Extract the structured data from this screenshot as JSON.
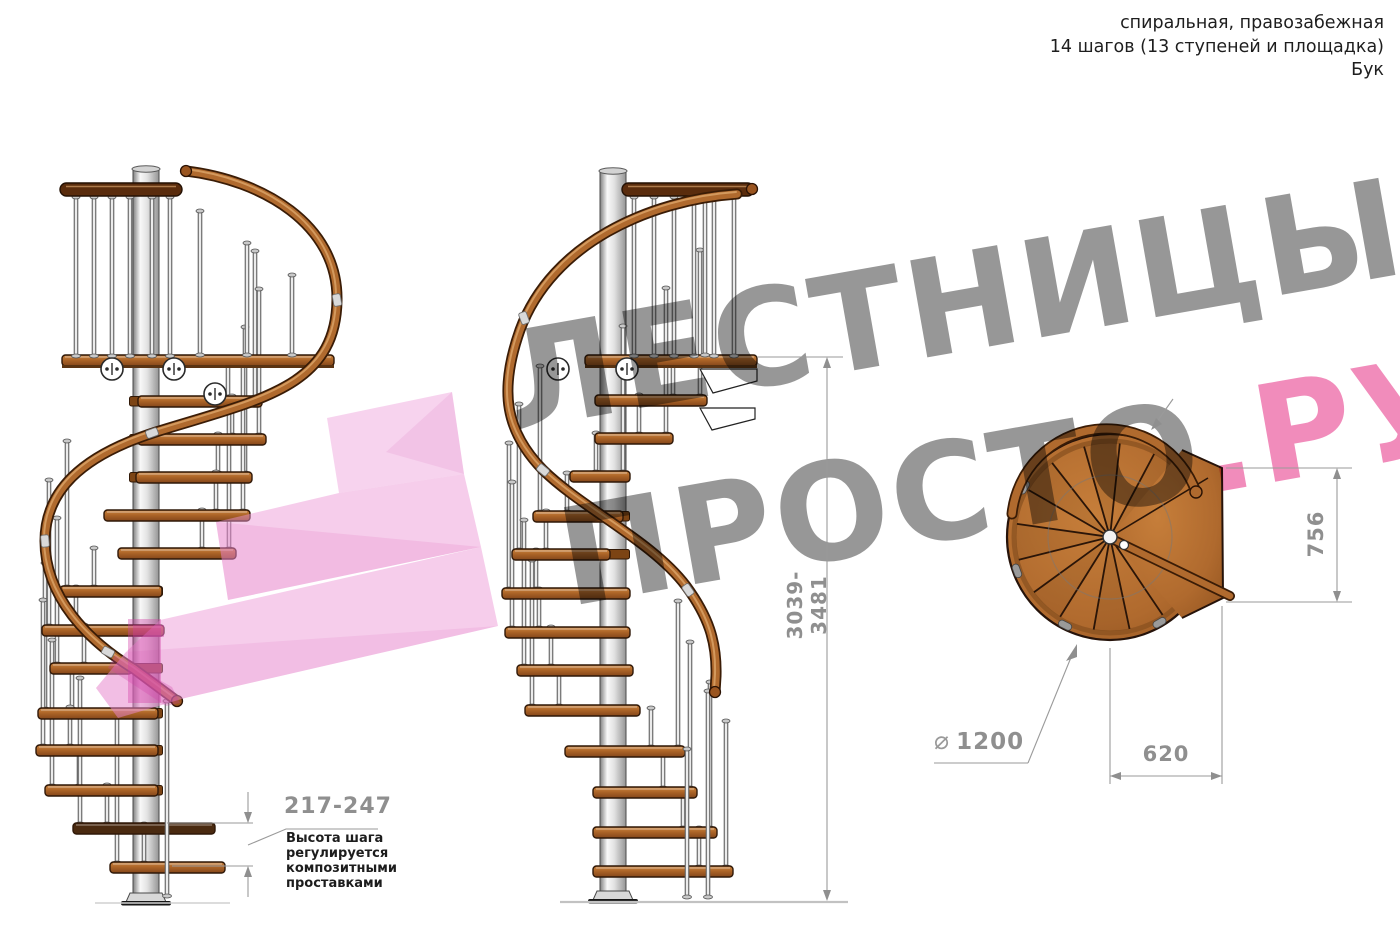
{
  "header": {
    "type_line": "спиральная, правозабежная",
    "steps_line": "14 шагов (13 ступеней и площадка)",
    "material_line": "Бук"
  },
  "watermark": {
    "word_top": "ЛЕСТНИЦЫ",
    "word_bottom_gray": "ПРОСТО",
    "word_bottom_pink": ".РУ"
  },
  "dimensions": {
    "total_height": "3039-3481",
    "step_height": "217-247",
    "platform_depth": "756",
    "platform_width": "620",
    "diameter_symbol": "⌀",
    "diameter_value": "1200"
  },
  "annotation": {
    "line1": "Высота шага",
    "line2": "регулируется",
    "line3": "композитными",
    "line4": "проставками"
  },
  "colors": {
    "wood": "#b06a2e",
    "wood_dark": "#6b3a12",
    "rail_dark": "#5a2c0d",
    "pole_metal": "#e6e6e6",
    "dimension_gray": "#8f8f8f",
    "text_dark": "#1e1e1e",
    "watermark_gray": "#808080",
    "watermark_pink": "#ee78af",
    "highlight_pink": "#f0a8dc"
  }
}
